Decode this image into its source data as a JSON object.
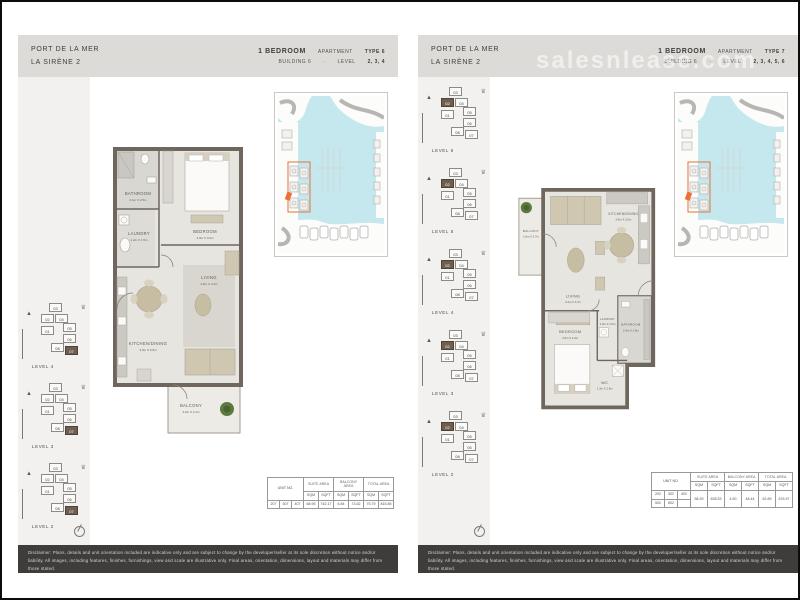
{
  "watermark": "salesnlease.com",
  "disclaimer": "Disclaimer: Plans, details and unit orientation included are indicative only and are subject to change by the developer/seller at its sole discretion without notice and/or liability. All images, including features, finishes, furnishings, view and scale are illustrative only. Final areas, orientation, dimensions, layout and materials may differ from those stated.",
  "colors": {
    "accent_orange": "#e8713a",
    "water_blue": "#c5e8ee",
    "wall_gray": "#6f665e",
    "header_band": "#dcdbd8",
    "footer_dark": "#3e3d3c"
  },
  "pages": [
    {
      "header": {
        "project": "PORT DE LA MER",
        "community": "LA SIRÈNE 2",
        "bedroom": "1 BEDROOM",
        "apartment_label": "APARTMENT",
        "type": "TYPE 6",
        "building": "BUILDING 6",
        "separator": "·",
        "level_label": "LEVEL",
        "levels": "2, 3, 4"
      },
      "key_plans": [
        {
          "label": "LEVEL 4"
        },
        {
          "label": "LEVEL 3"
        },
        {
          "label": "LEVEL 2"
        }
      ],
      "key_plan_units": [
        {
          "n": "03",
          "hl": "false"
        },
        {
          "n": "02",
          "hl": "false"
        },
        {
          "n": "04",
          "hl": "false"
        },
        {
          "n": "01",
          "hl": "false"
        },
        {
          "n": "05",
          "hl": "false"
        },
        {
          "n": "06",
          "hl": "false"
        },
        {
          "n": "08",
          "hl": "false"
        },
        {
          "n": "07",
          "hl": "true"
        }
      ],
      "rooms": {
        "bathroom": {
          "name": "BATHROOM",
          "dims": "2.1m X 2.5m"
        },
        "laundry": {
          "name": "LAUNDRY",
          "dims": "1.2m X 1.5m"
        },
        "bedroom": {
          "name": "BEDROOM",
          "dims": "4.0m X 3.6m"
        },
        "living": {
          "name": "LIVING",
          "dims": "3.6m X 4.4m"
        },
        "kitchen": {
          "name": "KITCHEN/DINING",
          "dims": "3.0m X 2.9m"
        },
        "balcony": {
          "name": "BALCONY",
          "dims": "4.0m X 2.1m"
        }
      },
      "table": {
        "unit_label": "UNIT NO.",
        "groups": [
          "SUITE AREA",
          "BALCONY AREA",
          "TOTAL AREA"
        ],
        "sqm": "SQM",
        "sqft": "SQFT",
        "units": [
          "207",
          "307",
          "407"
        ],
        "values": [
          "68.95",
          "742.17",
          "6.84",
          "73.62",
          "75.79",
          "815.85"
        ]
      }
    },
    {
      "header": {
        "project": "PORT DE LA MER",
        "community": "LA SIRÈNE 2",
        "bedroom": "1 BEDROOM",
        "apartment_label": "APARTMENT",
        "type": "TYPE 7",
        "building": "BUILDING 6",
        "separator": "·",
        "level_label": "LEVEL",
        "levels": "2, 3, 4, 5, 6"
      },
      "key_plans": [
        {
          "label": "LEVEL 6"
        },
        {
          "label": "LEVEL 5"
        },
        {
          "label": "LEVEL 4"
        },
        {
          "label": "LEVEL 3"
        },
        {
          "label": "LEVEL 2"
        }
      ],
      "key_plan_units": [
        {
          "n": "03",
          "hl": "false"
        },
        {
          "n": "02",
          "hl": "true"
        },
        {
          "n": "04",
          "hl": "false"
        },
        {
          "n": "01",
          "hl": "false"
        },
        {
          "n": "05",
          "hl": "false"
        },
        {
          "n": "06",
          "hl": "false"
        },
        {
          "n": "08",
          "hl": "false"
        },
        {
          "n": "07",
          "hl": "false"
        }
      ],
      "rooms": {
        "balcony": {
          "name": "BALCONY",
          "dims": "1.8m X 2.7m"
        },
        "living": {
          "name": "LIVING",
          "dims": "4.4m X 3.7m"
        },
        "kitchen": {
          "name": "KITCHEN/DINING",
          "dims": "3.9m X 3.0m"
        },
        "bedroom": {
          "name": "BEDROOM",
          "dims": "3.6m X 4.0m"
        },
        "laundry": {
          "name": "LAUNDRY",
          "dims": "1.0m X 1.5m"
        },
        "bathroom": {
          "name": "BATHROOM",
          "dims": "2.4m X 1.9m"
        },
        "wc": {
          "name": "WC",
          "dims": "1.3m X 1.9m"
        }
      },
      "table": {
        "unit_label": "UNIT NO.",
        "groups": [
          "SUITE AREA",
          "BALCONY AREA",
          "TOTAL AREA"
        ],
        "sqm": "SQM",
        "sqft": "SQFT",
        "units_row1": [
          "202",
          "302",
          "402"
        ],
        "units_row2": [
          "502",
          "602"
        ],
        "values": [
          "58.39",
          "628.53",
          "4.50",
          "48.44",
          "62.89",
          "676.97"
        ]
      }
    }
  ]
}
